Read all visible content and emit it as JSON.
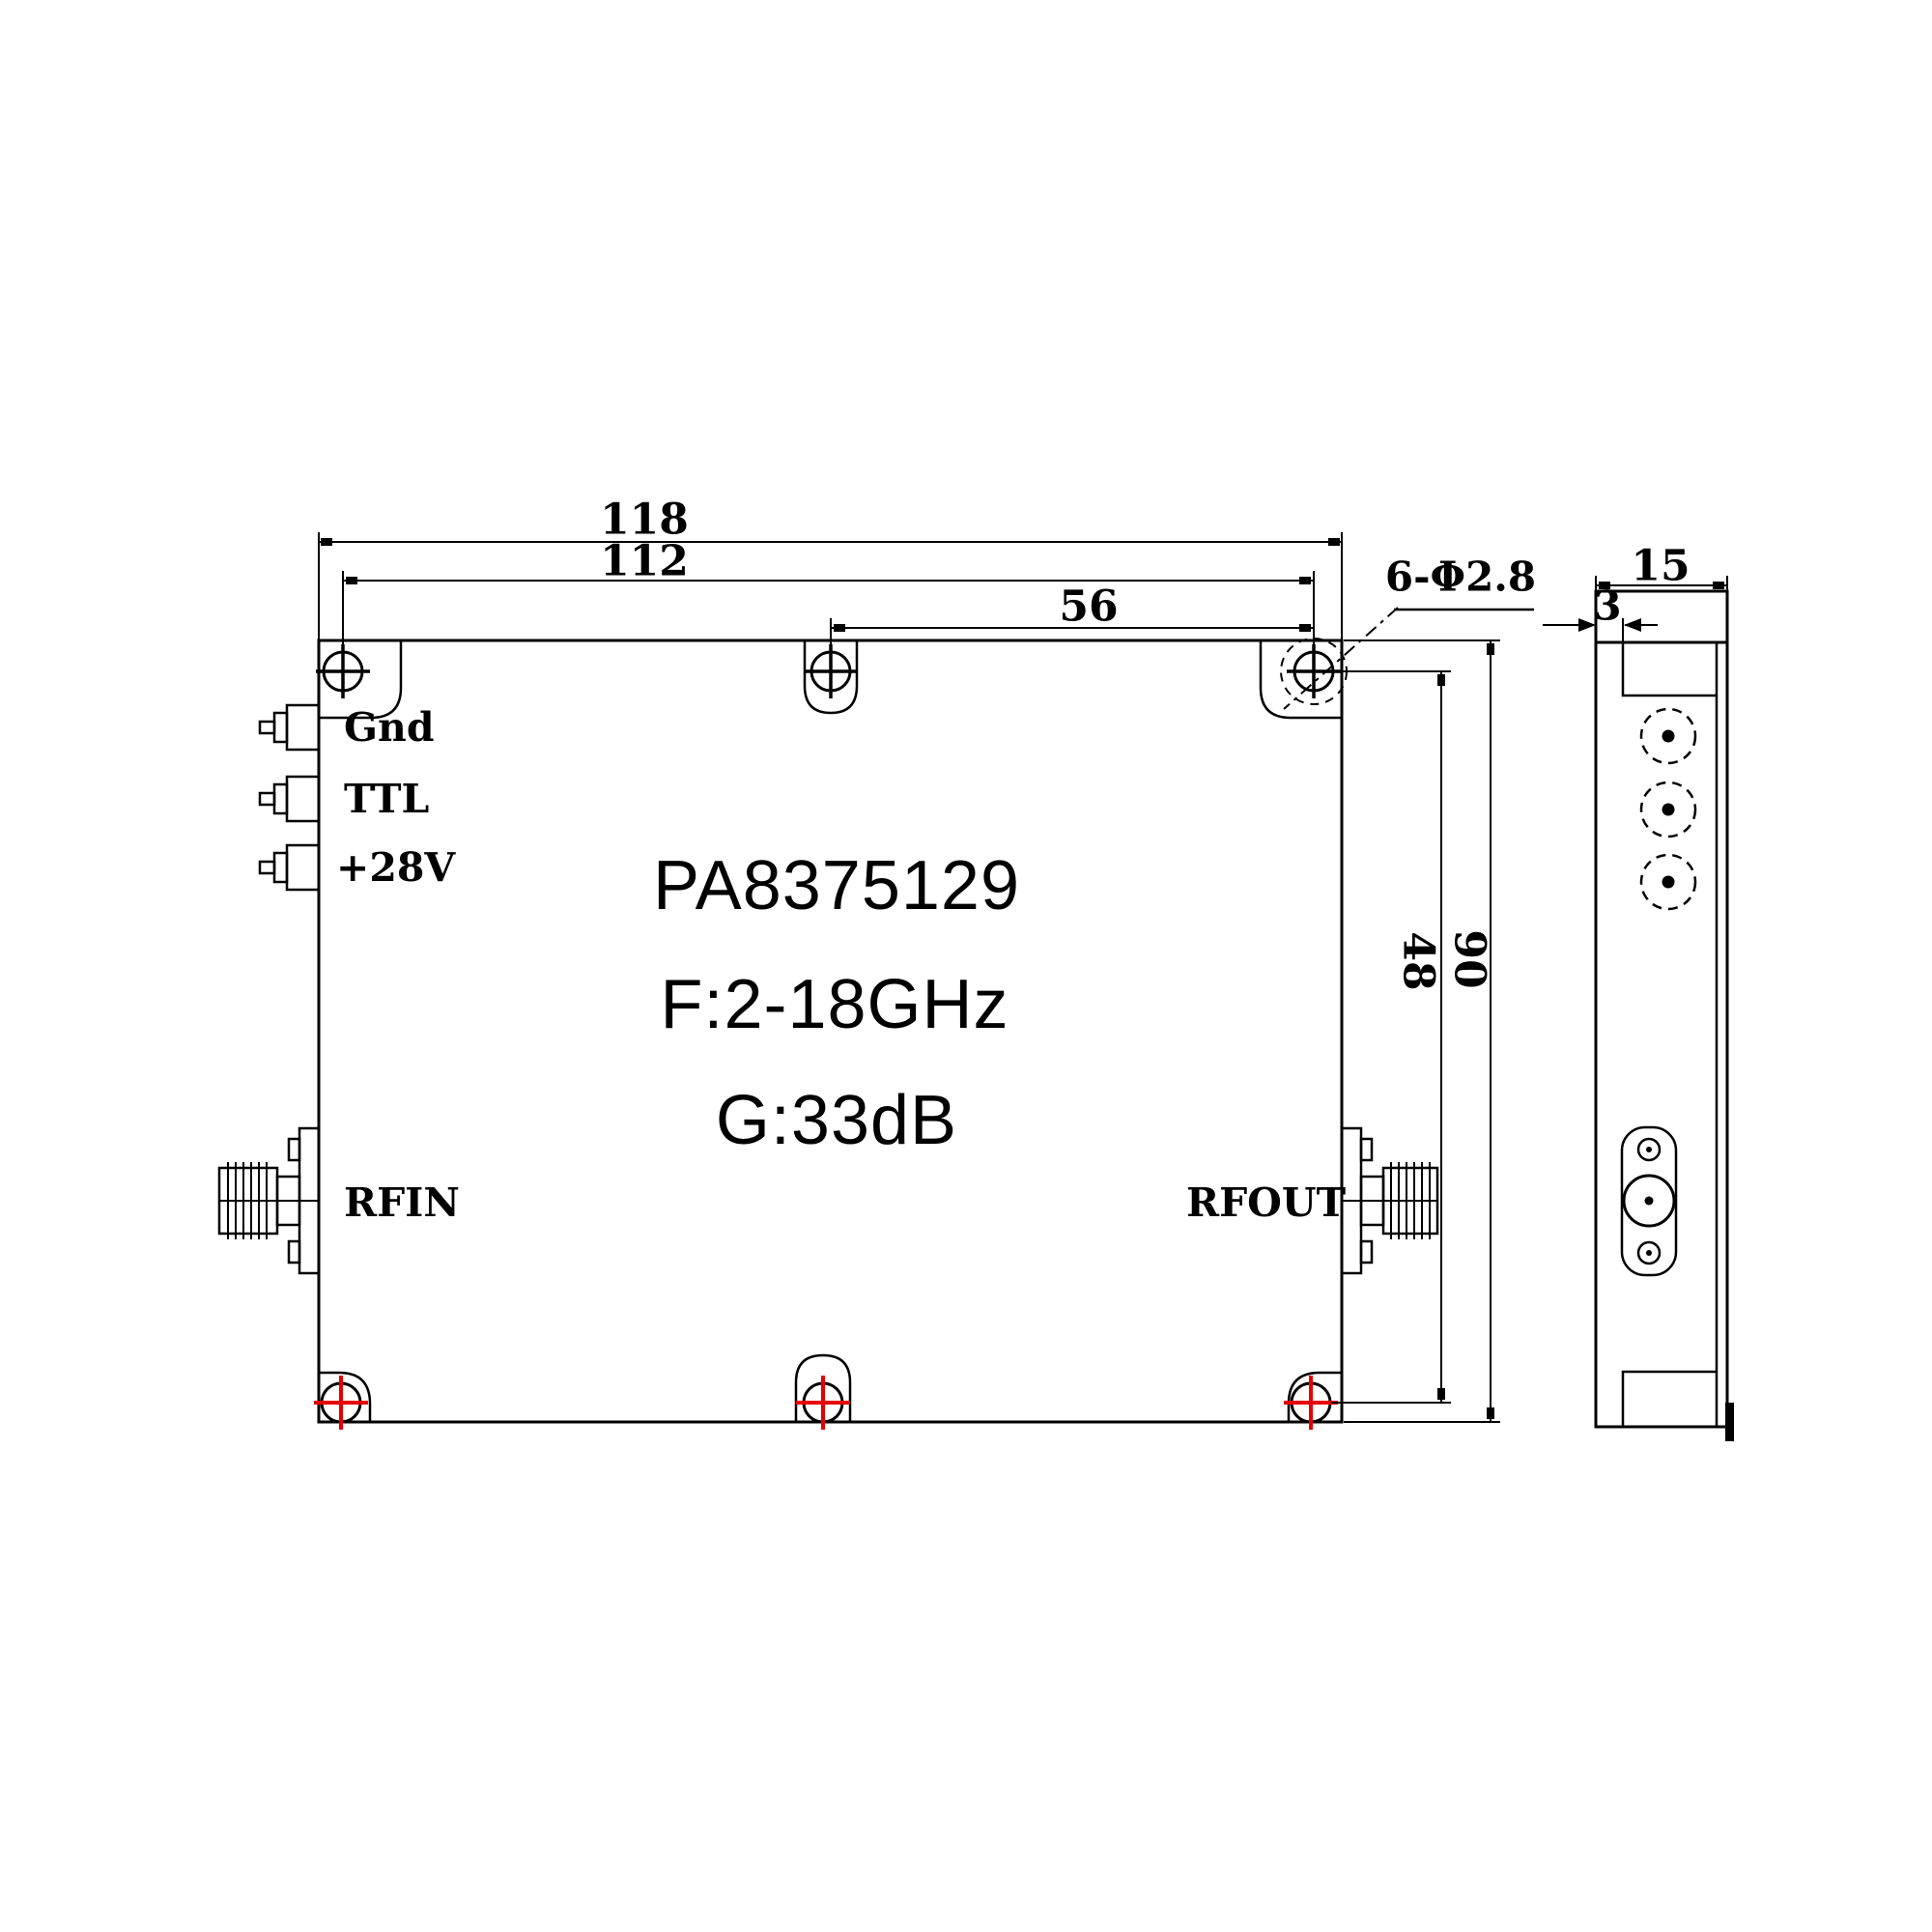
{
  "drawing": {
    "model": "PA8375129",
    "frequency": "F:2-18GHz",
    "gain": "G:33dB",
    "ports": {
      "gnd": "Gnd",
      "ttl": "TTL",
      "v28": "+28V",
      "rf_in": "RFIN",
      "rf_out": "RFOUT"
    },
    "dimensions": {
      "width_total": "118",
      "width_hole_span": "112",
      "width_half_span": "56",
      "hole_callout": "6-Φ2.8",
      "height_hole_span": "48",
      "height_total": "90",
      "depth": "15",
      "lid_thickness": "3"
    },
    "colors": {
      "line": "#000000",
      "hole_center_mark": "#e60000",
      "background": "#ffffff"
    }
  }
}
